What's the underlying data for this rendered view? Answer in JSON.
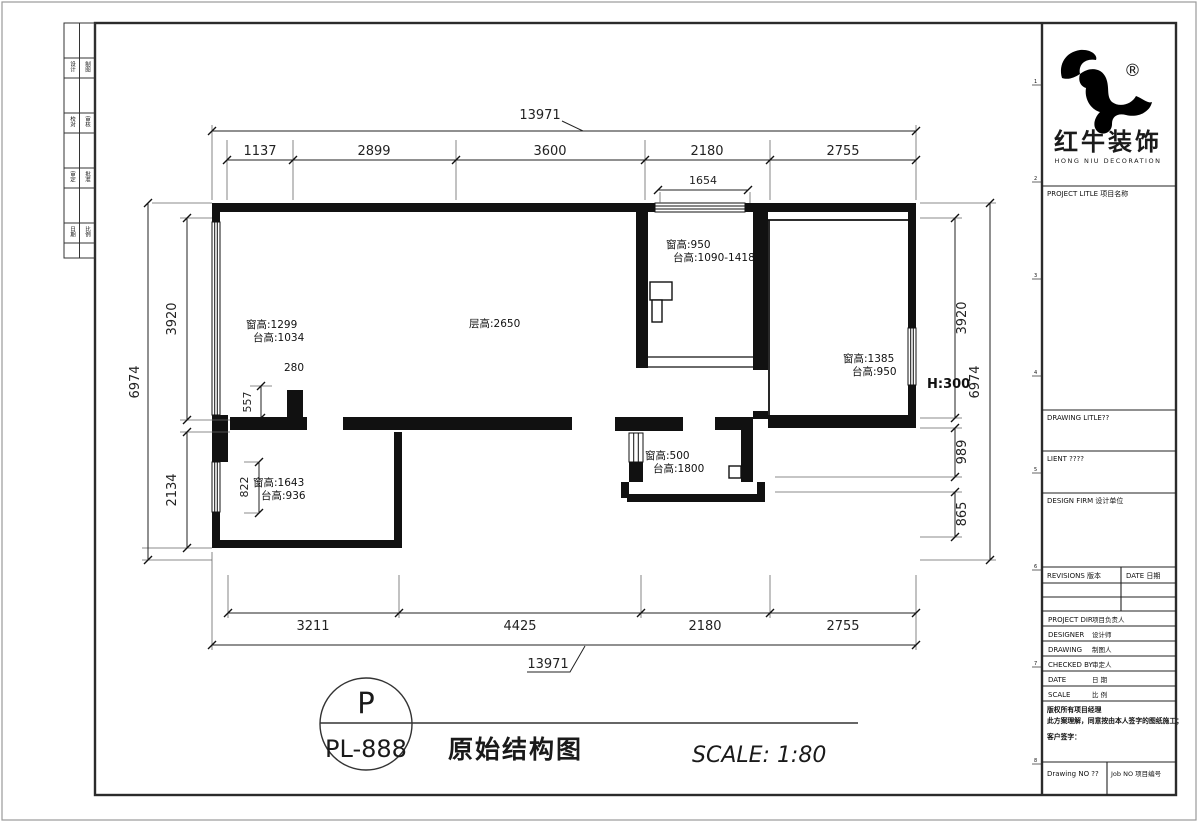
{
  "colors": {
    "ink": "#1a1a1a",
    "wall": "#111111",
    "paper": "#ffffff"
  },
  "sheet": {
    "circle_letter": "P",
    "code": "PL-888",
    "title": "原始结构图",
    "scale_label": "SCALE: 1:80"
  },
  "plan": {
    "dims": {
      "top_overall": "13971",
      "top_segments": [
        "1137",
        "2899",
        "3600",
        "2180",
        "2755"
      ],
      "top_sub": "1654",
      "bottom_segments": [
        "3211",
        "4425",
        "2180",
        "2755"
      ],
      "bottom_overall": "13971",
      "left_outer": "6974",
      "left_segments": [
        "3920",
        "2134"
      ],
      "left_subs": [
        "557",
        "822"
      ],
      "right_segments": [
        "3920",
        "989",
        "865"
      ],
      "right_outer": "6974"
    },
    "annotations": {
      "ceiling": "层高:2650",
      "beam": "280",
      "step": "H:300",
      "win_left_top": [
        "窗高:1299",
        "台高:1034"
      ],
      "win_left_bottom": [
        "窗高:1643",
        "台高:936"
      ],
      "win_top": [
        "窗高:950",
        "台高:1090-1418"
      ],
      "win_right": [
        "窗高:1385",
        "台高:950"
      ],
      "win_middle": [
        "窗高:500",
        "台高:1800"
      ]
    }
  },
  "margin_strip": {
    "rows": [
      {
        "left": "设计",
        "right": "制图"
      },
      {
        "left": "校对",
        "right": "审核"
      },
      {
        "left": "审定",
        "right": "批准"
      },
      {
        "left": "日期",
        "right": "比例"
      }
    ]
  },
  "title_block": {
    "brand_cn": "红牛装饰",
    "brand_en": "HONG NIU DECORATION",
    "registered": "®",
    "project_title": "PROJECT LITLE 项目名称",
    "drawing_title": "DRAWING LITLE??",
    "client": "LIENT ????",
    "design_firm": "DESIGN FIRM 设计单位",
    "revisions": "REVISIONS 版本",
    "date_col": "DATE 日期",
    "rows": [
      {
        "en": "PROJECT DIR",
        "cn": "项目负责人"
      },
      {
        "en": "DESIGNER",
        "cn": "设计师"
      },
      {
        "en": "DRAWING",
        "cn": "制图人"
      },
      {
        "en": "CHECKED BY",
        "cn": "审定人"
      },
      {
        "en": "DATE",
        "cn": "日 期"
      },
      {
        "en": "SCALE",
        "cn": "比 例"
      }
    ],
    "note1": "版权所有项目经理",
    "note2": "此方案理解，同意按由本人签字的图纸施工；",
    "note3": "客户签字：",
    "drawing_no": "Drawing NO ??",
    "job_no": "Job NO 项目编号",
    "edge_marks": [
      "1",
      "2",
      "3",
      "4",
      "5",
      "6",
      "7",
      "8"
    ]
  }
}
